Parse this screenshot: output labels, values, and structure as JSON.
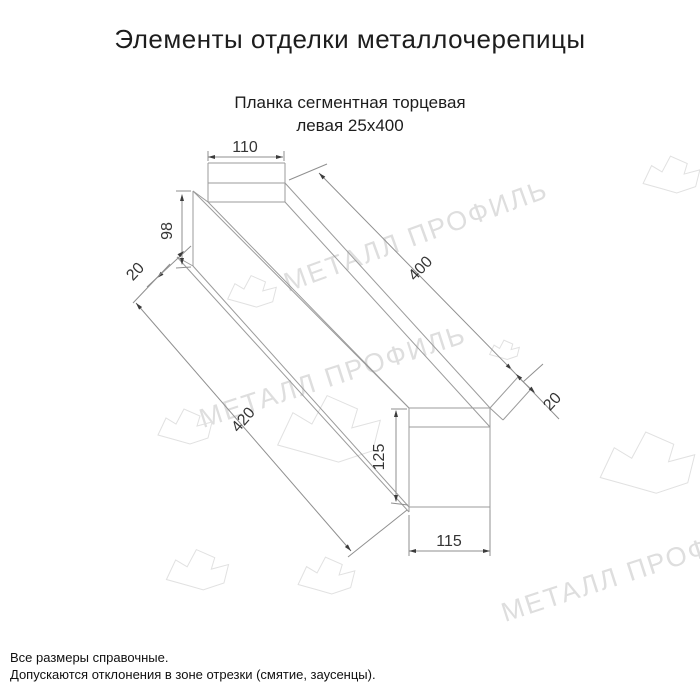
{
  "page": {
    "title": "Элементы отделки металлочерепицы",
    "subtitle_line1": "Планка сегментная торцевая",
    "subtitle_line2": "левая 25х400"
  },
  "dimensions": {
    "flange_width": "110",
    "left_face_height": "98",
    "left_fold": "20",
    "top_length": "400",
    "bottom_length": "420",
    "right_face_height": "125",
    "bottom_width": "115",
    "right_fold": "20"
  },
  "watermark": {
    "text": "МЕТАЛЛ ПРОФИЛЬ"
  },
  "footer": {
    "line1": "Все размеры справочные.",
    "line2": "Допускаются отклонения в зоне отрезки (смятие, заусенцы)."
  }
}
